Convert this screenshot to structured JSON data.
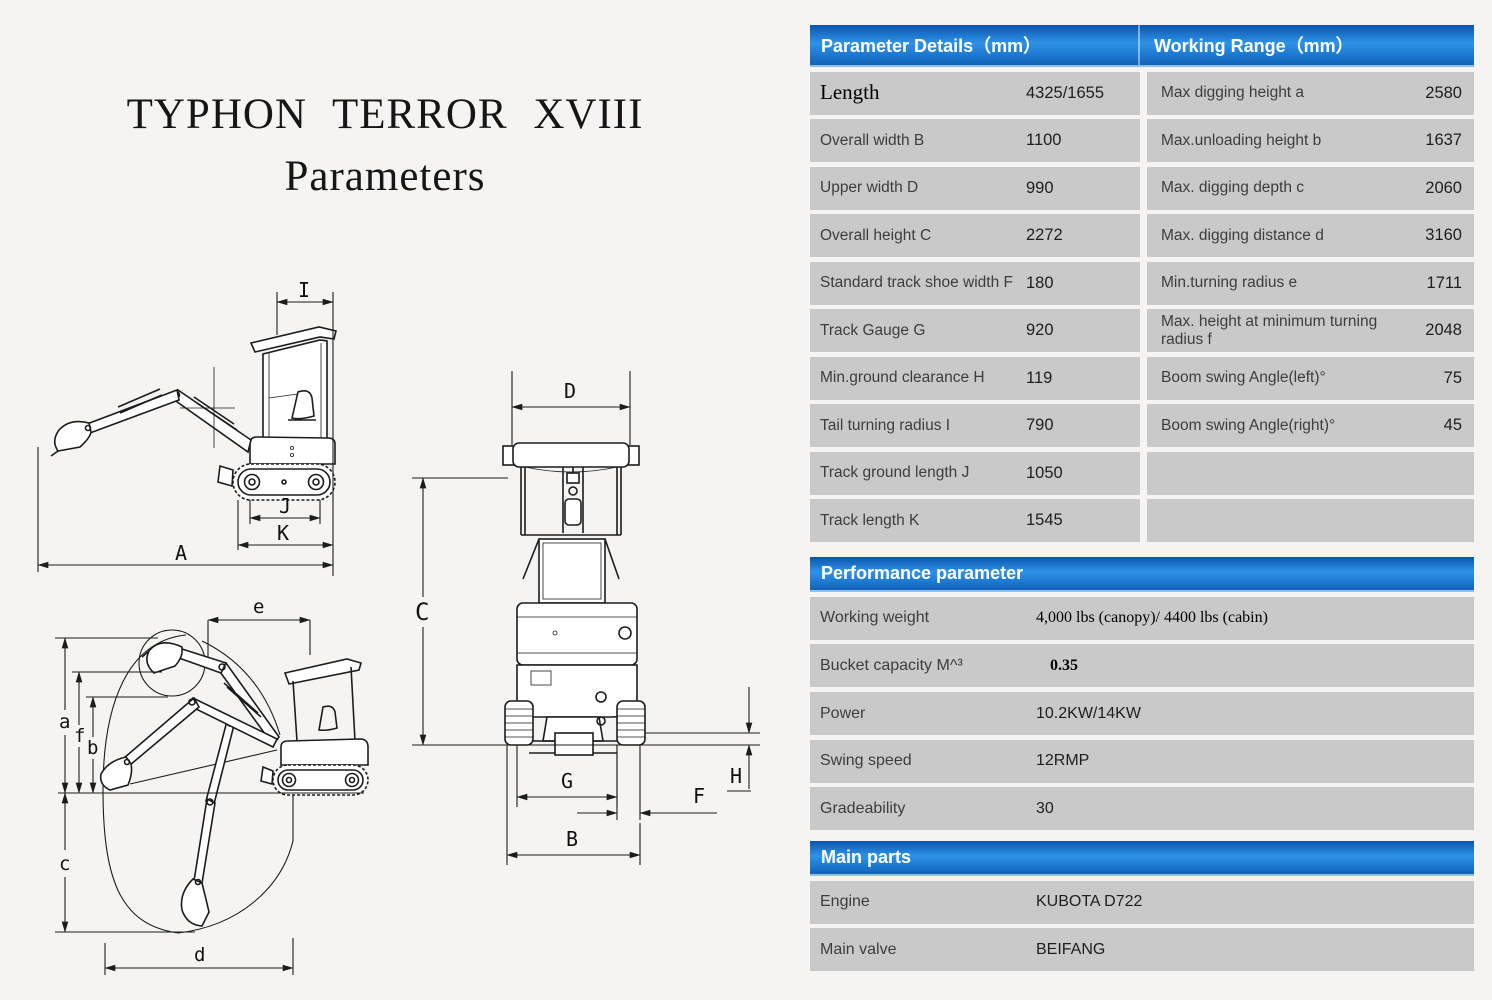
{
  "title": {
    "line1": "TYPHON  TERROR  XVIII",
    "line2": "Parameters"
  },
  "colors": {
    "header_blue": "#1b74cc",
    "row_gray": "#c9c9c9",
    "background": "#f5f4f2"
  },
  "dim_table": {
    "header_left": "Parameter Details（mm）",
    "header_right": "Working Range（mm）",
    "rows": [
      {
        "l_label": "Length",
        "l_value": "4325/1655",
        "r_label": "Max digging height a",
        "r_value": "2580"
      },
      {
        "l_label": "Overall width B",
        "l_value": "1100",
        "r_label": "Max.unloading height b",
        "r_value": "1637"
      },
      {
        "l_label": "Upper width D",
        "l_value": "990",
        "r_label": "Max. digging depth c",
        "r_value": "2060"
      },
      {
        "l_label": "Overall height C",
        "l_value": "2272",
        "r_label": "Max. digging distance d",
        "r_value": "3160"
      },
      {
        "l_label": "Standard track shoe width F",
        "l_value": "180",
        "r_label": "Min.turning radius e",
        "r_value": "1711"
      },
      {
        "l_label": "Track Gauge G",
        "l_value": "920",
        "r_label": "Max. height at minimum turning radius f",
        "r_value": "2048"
      },
      {
        "l_label": "Min.ground clearance H",
        "l_value": "119",
        "r_label": "Boom swing Angle(left)°",
        "r_value": "75"
      },
      {
        "l_label": "Tail turning radius I",
        "l_value": "790",
        "r_label": "Boom swing Angle(right)°",
        "r_value": "45"
      },
      {
        "l_label": "Track ground length J",
        "l_value": "1050",
        "r_label": "",
        "r_value": ""
      },
      {
        "l_label": "Track length K",
        "l_value": "1545",
        "r_label": "",
        "r_value": ""
      }
    ]
  },
  "performance": {
    "header": "Performance parameter",
    "rows": [
      {
        "label": "Working weight",
        "value": "4,000 lbs (canopy)/ 4400 lbs (cabin)"
      },
      {
        "label": "Bucket capacity M^³",
        "value": "0.35"
      },
      {
        "label": "Power",
        "value": "10.2KW/14KW"
      },
      {
        "label": "Swing speed",
        "value": "12RMP"
      },
      {
        "label": "Gradeability",
        "value": "30"
      }
    ]
  },
  "main_parts": {
    "header": "Main parts",
    "rows": [
      {
        "label": "Engine",
        "value": "KUBOTA D722"
      },
      {
        "label": "Main valve",
        "value": "BEIFANG"
      }
    ]
  },
  "diagrams": {
    "side_labels": [
      "I",
      "J",
      "K",
      "A"
    ],
    "front_labels": [
      "D",
      "C",
      "G",
      "F",
      "B",
      "H"
    ],
    "range_labels": [
      "e",
      "a",
      "f",
      "b",
      "c",
      "d"
    ]
  }
}
